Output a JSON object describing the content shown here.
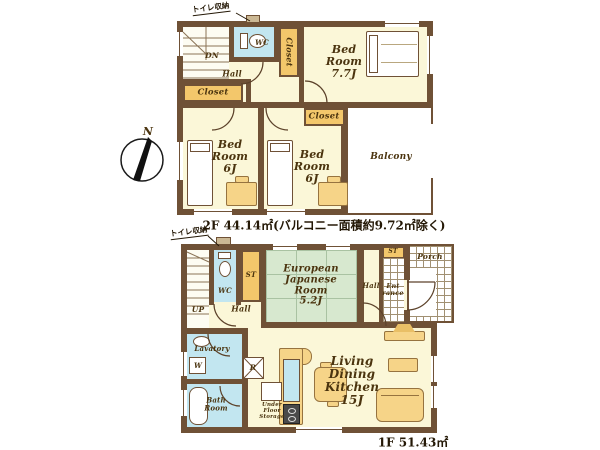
{
  "compass": {
    "north": "N"
  },
  "colors": {
    "wall": "#6f5136",
    "room": "#FBF7D8",
    "closet": "#F3C76B",
    "water": "#C2E6F0",
    "tatami": "#D7E8CF",
    "furniture": "#F6D488"
  },
  "floor2": {
    "area_text": "2F 44.14㎡(バルコニー面積約9.72㎡除く)",
    "note_toilet_storage": "トイレ収納",
    "stairs": "DN",
    "hall": "Hall",
    "wc": "WC",
    "closet_top": "Closet",
    "closet_left": "Closet",
    "closet_mid": "Closet",
    "bedroom_main": "Bed\nRoom\n7.7J",
    "bedroom_left": "Bed\nRoom\n6J",
    "bedroom_mid": "Bed\nRoom\n6J",
    "balcony": "Balcony"
  },
  "floor1": {
    "area_text": "1F 51.43㎡",
    "note_toilet_storage": "トイレ収納",
    "stairs": "UP",
    "hall_left": "Hall",
    "hall_right": "Hall",
    "wc": "WC",
    "storage_left": "ST",
    "storage_right": "ST",
    "japanese_room": "European\nJapanese\nRoom\n5.2J",
    "entrance": "Ent\nrance",
    "porch": "Porch",
    "lavatory": "Lavatory",
    "washer": "W",
    "bathroom": "Bath\nRoom",
    "refrigerator": "R",
    "under_floor_storage": "Under\nFloor\nStorage",
    "ldk": "Living\nDining\nKitchen\n15J"
  }
}
